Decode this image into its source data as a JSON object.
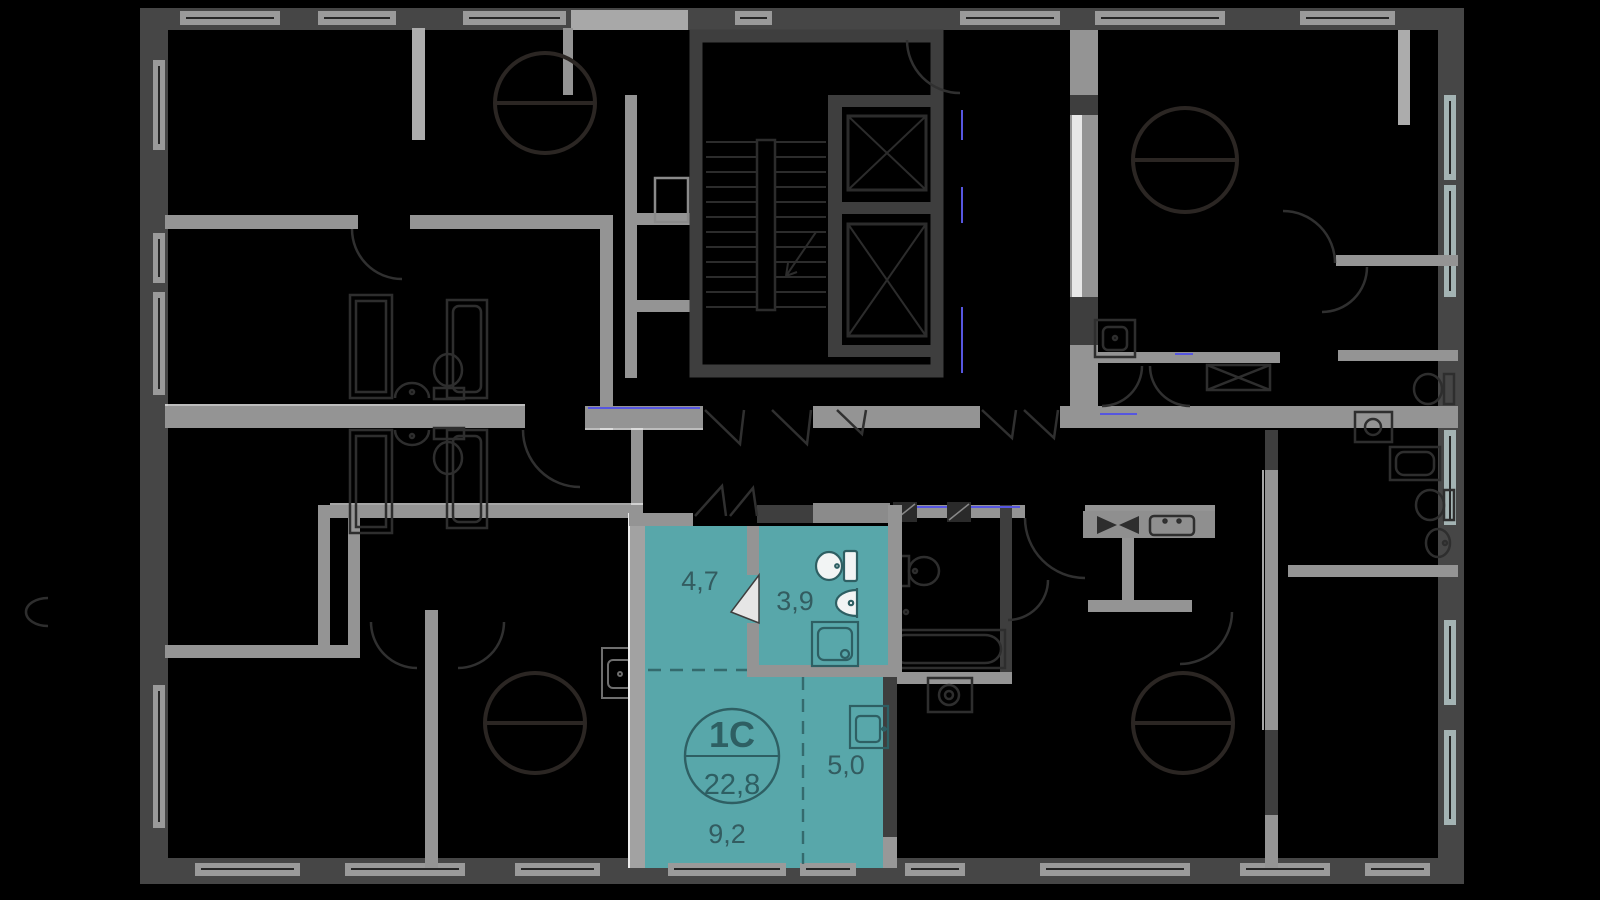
{
  "floor_plan": {
    "highlighted_apartment": {
      "type_label": "1С",
      "total_area_label": "22,8",
      "rooms": [
        {
          "name": "hallway",
          "area_label": "4,7"
        },
        {
          "name": "bathroom",
          "area_label": "3,9"
        },
        {
          "name": "kitchen-niche",
          "area_label": "5,0"
        },
        {
          "name": "living-room",
          "area_label": "9,2"
        }
      ]
    },
    "icons": [
      "staircase-icon",
      "elevator-icon",
      "toilet-icon",
      "sink-icon",
      "shower-icon",
      "bathtub-icon",
      "washing-machine-icon",
      "stove-icon",
      "kitchen-sink-icon",
      "round-table-icon",
      "door-arc-icon",
      "door-leaf-icon",
      "vent-shaft-icon",
      "wardrobe-icon"
    ],
    "colors": {
      "background": "#000000",
      "apartment_highlight": "#58A7AA",
      "apartment_line": "#2E5F63",
      "label_text": "#335C60",
      "wall_light": "#949494",
      "wall_dark": "#3E3E3E",
      "exterior_wall": "#464646",
      "window_glass": "#9A9A9A",
      "fixture_outline": "#2E2E2E",
      "door_arc": "#303030",
      "table_outline": "#2B2623",
      "accent_blue": "#5656E0",
      "edge_white": "#EDEDED"
    }
  }
}
